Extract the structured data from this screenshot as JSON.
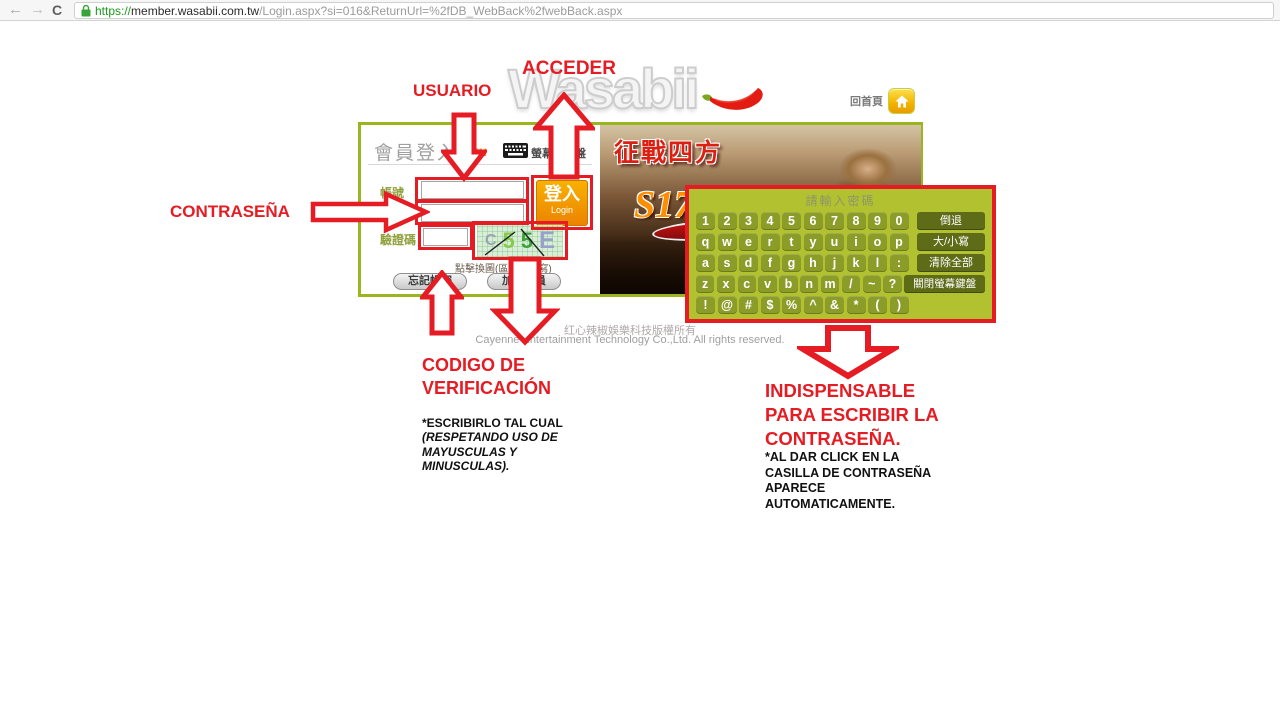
{
  "browser": {
    "back_glyph": "←",
    "forward_glyph": "→",
    "refresh_glyph": "C",
    "url_scheme": "https://",
    "url_host": "member.wasabii.com.tw",
    "url_path": "/Login.aspx?si=016&ReturnUrl=%2fDB_WebBack%2fwebBack.aspx"
  },
  "header": {
    "logo_text": "Wasabii",
    "home_label": "回首頁"
  },
  "login": {
    "title": "會員登入",
    "title_suffix": "LOGIN",
    "screen_keyboard_label": "螢幕小鍵盤",
    "account_label": "帳號",
    "password_label": "密碼",
    "captcha_label": "驗證碼",
    "captcha_chars": [
      {
        "ch": "C",
        "color": "#9aa4b0",
        "size": "16px"
      },
      {
        "ch": "5",
        "color": "#86ca4a",
        "size": "22px"
      },
      {
        "ch": "5",
        "color": "#3da23a",
        "size": "22px"
      },
      {
        "ch": "E",
        "color": "#9aa0cc",
        "size": "24px"
      }
    ],
    "captcha_hint": "點擊換圖(區分大小寫)",
    "login_button": "登入",
    "login_button_sub": "Login",
    "forgot_button": "忘記帳密",
    "join_button": "加入會員"
  },
  "banner": {
    "game_title": "征戰四方",
    "server_label": "S17"
  },
  "keyboard": {
    "title": "請輸入密碼",
    "rows": [
      [
        "1",
        "2",
        "3",
        "4",
        "5",
        "6",
        "7",
        "8",
        "9",
        "0"
      ],
      [
        "q",
        "w",
        "e",
        "r",
        "t",
        "y",
        "u",
        "i",
        "o",
        "p"
      ],
      [
        "a",
        "s",
        "d",
        "f",
        "g",
        "h",
        "j",
        "k",
        "l",
        ":"
      ],
      [
        "z",
        "x",
        "c",
        "v",
        "b",
        "n",
        "m",
        "/",
        "~",
        "?"
      ],
      [
        "!",
        "@",
        "#",
        "$",
        "%",
        "^",
        "&",
        "*",
        "(",
        ")"
      ]
    ],
    "side_keys": [
      "倒退",
      "大/小寫",
      "清除全部",
      "關閉螢幕鍵盤"
    ]
  },
  "footer": {
    "line1": "红心辣椒娛樂科技版權所有",
    "line2": "Cayenne Entertainment Technology Co.,Ltd. All rights reserved."
  },
  "annotations": {
    "usuario": "USUARIO",
    "acceder": "ACCEDER",
    "contrasena": "CONTRASEÑA",
    "codigo_title": "CODIGO DE\nVERIFICACIÓN",
    "codigo_note_1": "*ESCRIBIRLO TAL CUAL",
    "codigo_note_2": "(RESPETANDO USO DE\nMAYUSCULAS Y\nMINUSCULAS).",
    "indispensable_title": "INDISPENSABLE\nPARA ESCRIBIR LA\nCONTRASEÑA.",
    "indispensable_note": "*AL DAR CLICK EN LA\nCASILLA DE CONTRASEÑA\nAPARECE\nAUTOMATICAMENTE."
  }
}
